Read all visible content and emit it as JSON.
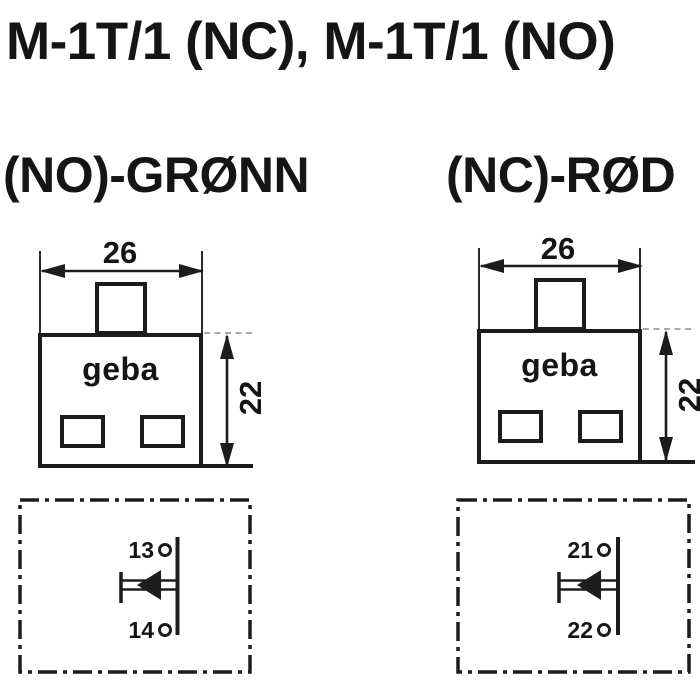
{
  "title": "M-1T/1 (NC), M-1T/1 (NO)",
  "variant_labels": {
    "left": "(NO)-GRØNN",
    "right": "(NC)-RØD"
  },
  "devices": [
    {
      "brand": "geba",
      "width_dim": "26",
      "height_dim": "22"
    },
    {
      "brand": "geba",
      "width_dim": "26",
      "height_dim": "22"
    }
  ],
  "contact_diagrams": [
    {
      "top_terminal": "13",
      "bottom_terminal": "14"
    },
    {
      "top_terminal": "21",
      "bottom_terminal": "22"
    }
  ],
  "colors": {
    "line": "#1c1c1c",
    "background": "#ffffff",
    "faint_line": "#a8a8a8"
  }
}
